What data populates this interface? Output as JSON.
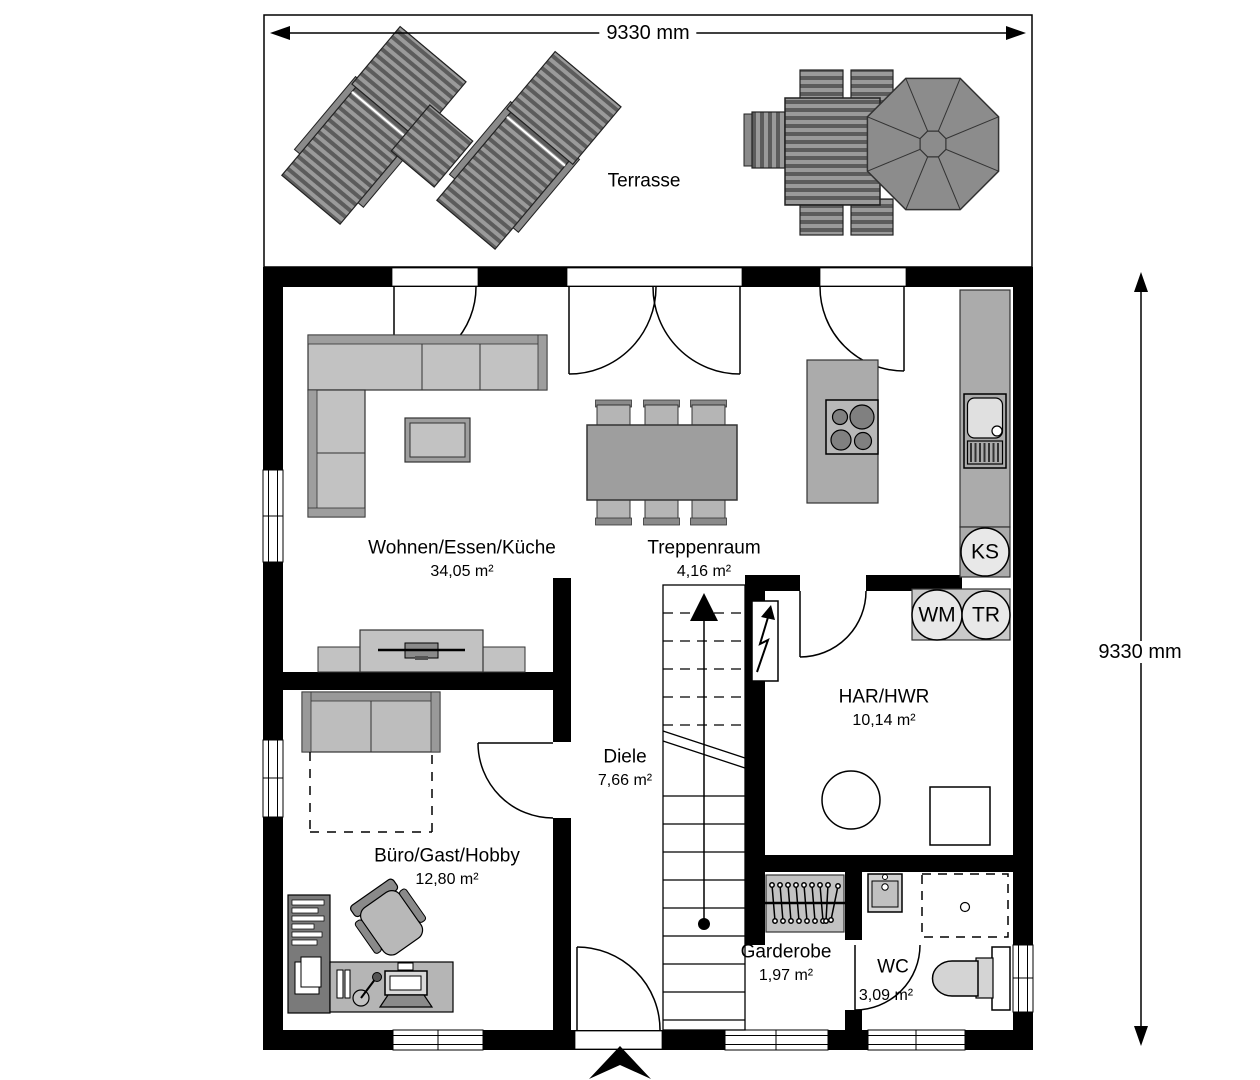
{
  "dimensions": {
    "width_top": "9330 mm",
    "height_right": "9330 mm"
  },
  "terrace": {
    "label": "Terrasse"
  },
  "rooms": {
    "living": {
      "name": "Wohnen/Essen/Küche",
      "area": "34,05 m²"
    },
    "stairs": {
      "name": "Treppenraum",
      "area": "4,16 m²"
    },
    "utility": {
      "name": "HAR/HWR",
      "area": "10,14 m²"
    },
    "hall": {
      "name": "Diele",
      "area": "7,66 m²"
    },
    "office": {
      "name": "Büro/Gast/Hobby",
      "area": "12,80 m²"
    },
    "wardrobe": {
      "name": "Garderobe",
      "area": "1,97 m²"
    },
    "wc": {
      "name": "WC",
      "area": "3,09 m²"
    }
  },
  "appliances": {
    "fridge": "KS",
    "washing_machine": "WM",
    "dryer": "TR"
  },
  "palette": {
    "wall": "#000000",
    "floor": "#ffffff",
    "furniture_light": "#c2c2c2",
    "furniture_mid": "#9e9e9e",
    "furniture_dark": "#7a7a7a",
    "deck_dark": "#5c5c5c",
    "deck_light": "#9a9a9a",
    "outline": "#333333"
  }
}
